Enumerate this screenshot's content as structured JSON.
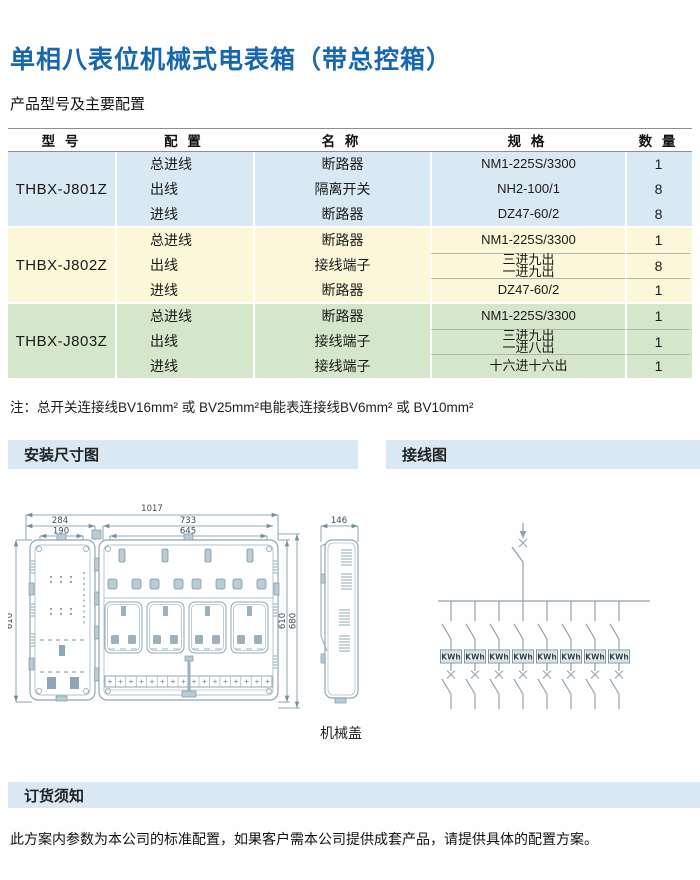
{
  "header": {
    "title": "单相八表位机械式电表箱（带总控箱）",
    "subtitle": "产品型号及主要配置"
  },
  "table": {
    "headers": [
      "型 号",
      "配 置",
      "名 称",
      "规 格",
      "数 量"
    ],
    "groups": [
      {
        "model": "THBX-J801Z",
        "bg_color": "#d9e9f4",
        "rows": [
          {
            "config": "总进线",
            "name": "断路器",
            "spec": "NM1-225S/3300",
            "qty": "1"
          },
          {
            "config": "出线",
            "name": "隔离开关",
            "spec": "NH2-100/1",
            "qty": "8"
          },
          {
            "config": "进线",
            "name": "断路器",
            "spec": "DZ47-60/2",
            "qty": "8"
          }
        ]
      },
      {
        "model": "THBX-J802Z",
        "bg_color": "#fbf7d8",
        "rows": [
          {
            "config": "总进线",
            "name": "断路器",
            "spec": "NM1-225S/3300",
            "qty": "1"
          },
          {
            "config": "出线",
            "name": "接线端子",
            "spec": "三进九出\n一进九出",
            "qty": "8"
          },
          {
            "config": "进线",
            "name": "断路器",
            "spec": "DZ47-60/2",
            "qty": "1"
          }
        ]
      },
      {
        "model": "THBX-J803Z",
        "bg_color": "#d5e7ca",
        "rows": [
          {
            "config": "总进线",
            "name": "断路器",
            "spec": "NM1-225S/3300",
            "qty": "1"
          },
          {
            "config": "出线",
            "name": "接线端子",
            "spec": "三进九出\n一进八出",
            "qty": "1"
          },
          {
            "config": "进线",
            "name": "接线端子",
            "spec": "十六进十六出",
            "qty": "1"
          }
        ]
      }
    ]
  },
  "note": "注：总开关连接线BV16mm² 或 BV25mm²电能表连接线BV6mm² 或 BV10mm²",
  "sections": {
    "install": "安装尺寸图",
    "wiring": "接线图",
    "order": "订货须知"
  },
  "drawing": {
    "dim_overall": "1017",
    "dim_left_outer": "284",
    "dim_left_inner": "190",
    "dim_right_outer": "733",
    "dim_right_inner": "645",
    "dim_side": "146",
    "dim_height_left": "610",
    "dim_height_right": "610",
    "dim_height_total": "680",
    "cover_label": "机械盖"
  },
  "wiring": {
    "kwh_label": "KWh"
  },
  "footer": {
    "text": "此方案内参数为本公司的标准配置，如果客户需本公司提供成套产品，请提供具体的配置方案。"
  },
  "colors": {
    "title_blue": "#1767b0",
    "group1_bg": "#d9e9f4",
    "group2_bg": "#fbf7d8",
    "group3_bg": "#d5e7ca",
    "section_bar_bg": "#d9e8f2",
    "drawing_stroke": "#9bb0bc"
  }
}
